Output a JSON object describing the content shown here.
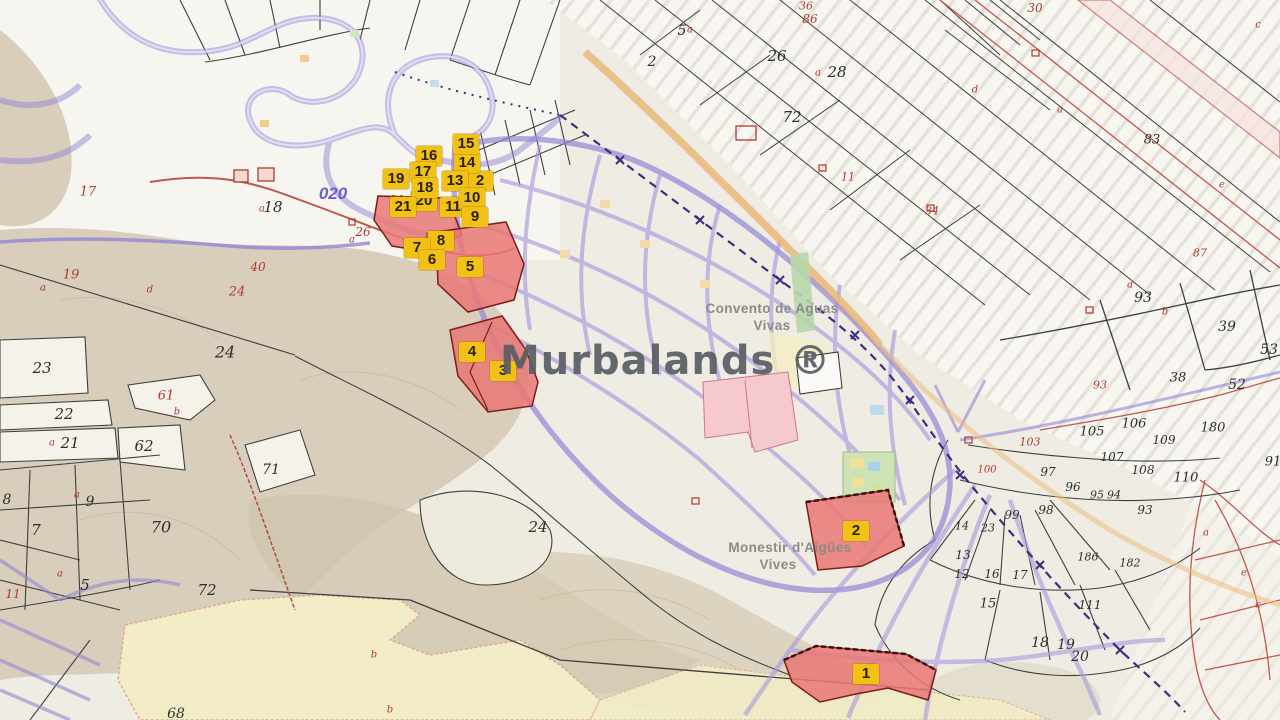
{
  "watermark": "Murbalands ®",
  "road_code": "020",
  "places": {
    "convento_line1": "Convento de Aguas",
    "convento_line2": "Vivas",
    "monestir_line1": "Monestir d'Aigües",
    "monestir_line2": "Vives"
  },
  "colors": {
    "marker_bg": "#F2C115",
    "marker_text": "#2B2300",
    "parcel_fill": "#E87873",
    "parcel_stroke": "#7C1D16",
    "road_purple": "#9486D6",
    "boundary_black": "#3F3F3F",
    "boundary_red": "#C4574A",
    "label_black": "#2E2E2E",
    "label_red": "#B03A2E",
    "place_gray": "#8B8B8B",
    "road_code_blue": "#6F5FD0",
    "watermark_gray": "#5B6065"
  },
  "markers": [
    {
      "label": "2",
      "x": 480,
      "y": 181
    },
    {
      "label": "20",
      "x": 424,
      "y": 201
    },
    {
      "label": "14",
      "x": 467,
      "y": 163
    },
    {
      "label": "15",
      "x": 466,
      "y": 144
    },
    {
      "label": "16",
      "x": 429,
      "y": 156
    },
    {
      "label": "17",
      "x": 423,
      "y": 172
    },
    {
      "label": "19",
      "x": 396,
      "y": 179
    },
    {
      "label": "13",
      "x": 455,
      "y": 181
    },
    {
      "label": "18",
      "x": 425,
      "y": 188
    },
    {
      "label": "21",
      "x": 403,
      "y": 207
    },
    {
      "label": "11",
      "x": 453,
      "y": 207
    },
    {
      "label": "10",
      "x": 472,
      "y": 198
    },
    {
      "label": "9",
      "x": 475,
      "y": 217
    },
    {
      "label": "8",
      "x": 441,
      "y": 241
    },
    {
      "label": "7",
      "x": 417,
      "y": 248
    },
    {
      "label": "6",
      "x": 432,
      "y": 260
    },
    {
      "label": "5",
      "x": 470,
      "y": 267
    },
    {
      "label": "4",
      "x": 472,
      "y": 352
    },
    {
      "label": "3",
      "x": 503,
      "y": 371
    },
    {
      "label": "2",
      "x": 856,
      "y": 531
    },
    {
      "label": "1",
      "x": 866,
      "y": 674
    }
  ],
  "parcel_numbers": {
    "black": [
      {
        "t": "18",
        "x": 273,
        "y": 207,
        "s": 15
      },
      {
        "t": "23",
        "x": 42,
        "y": 368,
        "s": 15
      },
      {
        "t": "22",
        "x": 64,
        "y": 414,
        "s": 15
      },
      {
        "t": "21",
        "x": 70,
        "y": 443,
        "s": 15
      },
      {
        "t": "62",
        "x": 144,
        "y": 446,
        "s": 15
      },
      {
        "t": "24",
        "x": 225,
        "y": 352,
        "s": 16
      },
      {
        "t": "71",
        "x": 271,
        "y": 470,
        "s": 14
      },
      {
        "t": "8",
        "x": 7,
        "y": 500,
        "s": 14
      },
      {
        "t": "9",
        "x": 90,
        "y": 502,
        "s": 14
      },
      {
        "t": "7",
        "x": 36,
        "y": 530,
        "s": 15
      },
      {
        "t": "70",
        "x": 161,
        "y": 527,
        "s": 16
      },
      {
        "t": "5",
        "x": 85,
        "y": 585,
        "s": 15
      },
      {
        "t": "72",
        "x": 207,
        "y": 590,
        "s": 15
      },
      {
        "t": "24",
        "x": 538,
        "y": 527,
        "s": 15
      },
      {
        "t": "68",
        "x": 176,
        "y": 714,
        "s": 14
      },
      {
        "t": "2",
        "x": 652,
        "y": 62,
        "s": 14
      },
      {
        "t": "5",
        "x": 682,
        "y": 31,
        "s": 14
      },
      {
        "t": "26",
        "x": 777,
        "y": 56,
        "s": 15
      },
      {
        "t": "28",
        "x": 837,
        "y": 72,
        "s": 15
      },
      {
        "t": "72",
        "x": 792,
        "y": 117,
        "s": 15
      },
      {
        "t": "83",
        "x": 1152,
        "y": 140,
        "s": 13
      },
      {
        "t": "93",
        "x": 1143,
        "y": 298,
        "s": 14
      },
      {
        "t": "39",
        "x": 1227,
        "y": 327,
        "s": 14
      },
      {
        "t": "53",
        "x": 1269,
        "y": 350,
        "s": 14
      },
      {
        "t": "38",
        "x": 1178,
        "y": 378,
        "s": 13
      },
      {
        "t": "52",
        "x": 1237,
        "y": 385,
        "s": 14
      },
      {
        "t": "180",
        "x": 1213,
        "y": 428,
        "s": 13
      },
      {
        "t": "106",
        "x": 1134,
        "y": 424,
        "s": 13
      },
      {
        "t": "105",
        "x": 1092,
        "y": 432,
        "s": 13
      },
      {
        "t": "109",
        "x": 1164,
        "y": 440,
        "s": 12
      },
      {
        "t": "107",
        "x": 1112,
        "y": 457,
        "s": 12
      },
      {
        "t": "108",
        "x": 1143,
        "y": 470,
        "s": 12
      },
      {
        "t": "110",
        "x": 1186,
        "y": 478,
        "s": 13
      },
      {
        "t": "97",
        "x": 1048,
        "y": 472,
        "s": 12
      },
      {
        "t": "96",
        "x": 1073,
        "y": 487,
        "s": 12
      },
      {
        "t": "95",
        "x": 1097,
        "y": 495,
        "s": 11
      },
      {
        "t": "94",
        "x": 1114,
        "y": 495,
        "s": 11
      },
      {
        "t": "99",
        "x": 1012,
        "y": 515,
        "s": 12
      },
      {
        "t": "98",
        "x": 1046,
        "y": 510,
        "s": 12
      },
      {
        "t": "93",
        "x": 1145,
        "y": 510,
        "s": 12
      },
      {
        "t": "91",
        "x": 1273,
        "y": 462,
        "s": 13
      },
      {
        "t": "14",
        "x": 962,
        "y": 526,
        "s": 11
      },
      {
        "t": "23",
        "x": 988,
        "y": 528,
        "s": 11
      },
      {
        "t": "13",
        "x": 963,
        "y": 555,
        "s": 12
      },
      {
        "t": "12",
        "x": 962,
        "y": 574,
        "s": 12
      },
      {
        "t": "16",
        "x": 992,
        "y": 574,
        "s": 12
      },
      {
        "t": "17",
        "x": 1020,
        "y": 575,
        "s": 12
      },
      {
        "t": "15",
        "x": 988,
        "y": 604,
        "s": 13
      },
      {
        "t": "18",
        "x": 1040,
        "y": 643,
        "s": 14
      },
      {
        "t": "19",
        "x": 1066,
        "y": 645,
        "s": 14
      },
      {
        "t": "20",
        "x": 1080,
        "y": 657,
        "s": 14
      },
      {
        "t": "111",
        "x": 1090,
        "y": 605,
        "s": 12
      },
      {
        "t": "186",
        "x": 1088,
        "y": 557,
        "s": 11
      },
      {
        "t": "182",
        "x": 1130,
        "y": 563,
        "s": 11
      }
    ],
    "red": [
      {
        "t": "17",
        "x": 88,
        "y": 192,
        "s": 13
      },
      {
        "t": "19",
        "x": 71,
        "y": 275,
        "s": 13
      },
      {
        "t": "40",
        "x": 258,
        "y": 267,
        "s": 12
      },
      {
        "t": "24",
        "x": 237,
        "y": 292,
        "s": 13
      },
      {
        "t": "61",
        "x": 166,
        "y": 396,
        "s": 13
      },
      {
        "t": "26",
        "x": 363,
        "y": 232,
        "s": 12
      },
      {
        "t": "20",
        "x": 397,
        "y": 200,
        "s": 12
      },
      {
        "t": "11",
        "x": 13,
        "y": 594,
        "s": 12
      },
      {
        "t": "36",
        "x": 806,
        "y": 6,
        "s": 11
      },
      {
        "t": "86",
        "x": 810,
        "y": 19,
        "s": 12
      },
      {
        "t": "11",
        "x": 848,
        "y": 177,
        "s": 11
      },
      {
        "t": "34",
        "x": 932,
        "y": 211,
        "s": 11
      },
      {
        "t": "30",
        "x": 1035,
        "y": 8,
        "s": 12
      },
      {
        "t": "87",
        "x": 1200,
        "y": 253,
        "s": 11
      },
      {
        "t": "93",
        "x": 1100,
        "y": 385,
        "s": 11
      },
      {
        "t": "103",
        "x": 1030,
        "y": 442,
        "s": 11
      },
      {
        "t": "100",
        "x": 987,
        "y": 470,
        "s": 10
      }
    ],
    "letters": [
      {
        "t": "a",
        "x": 43,
        "y": 288
      },
      {
        "t": "d",
        "x": 150,
        "y": 290
      },
      {
        "t": "b",
        "x": 177,
        "y": 412
      },
      {
        "t": "a",
        "x": 52,
        "y": 443
      },
      {
        "t": "a",
        "x": 77,
        "y": 495
      },
      {
        "t": "a",
        "x": 60,
        "y": 574
      },
      {
        "t": "a",
        "x": 262,
        "y": 209
      },
      {
        "t": "a",
        "x": 352,
        "y": 240
      },
      {
        "t": "a",
        "x": 690,
        "y": 30
      },
      {
        "t": "a",
        "x": 818,
        "y": 73
      },
      {
        "t": "d",
        "x": 975,
        "y": 90
      },
      {
        "t": "a",
        "x": 1060,
        "y": 110
      },
      {
        "t": "c",
        "x": 1258,
        "y": 25
      },
      {
        "t": "e",
        "x": 1222,
        "y": 185
      },
      {
        "t": "a",
        "x": 1130,
        "y": 285
      },
      {
        "t": "b",
        "x": 1165,
        "y": 312
      },
      {
        "t": "a",
        "x": 1206,
        "y": 533
      },
      {
        "t": "e",
        "x": 1244,
        "y": 573
      },
      {
        "t": "c",
        "x": 1258,
        "y": 605
      },
      {
        "t": "b",
        "x": 374,
        "y": 655
      },
      {
        "t": "b",
        "x": 390,
        "y": 710
      }
    ]
  }
}
